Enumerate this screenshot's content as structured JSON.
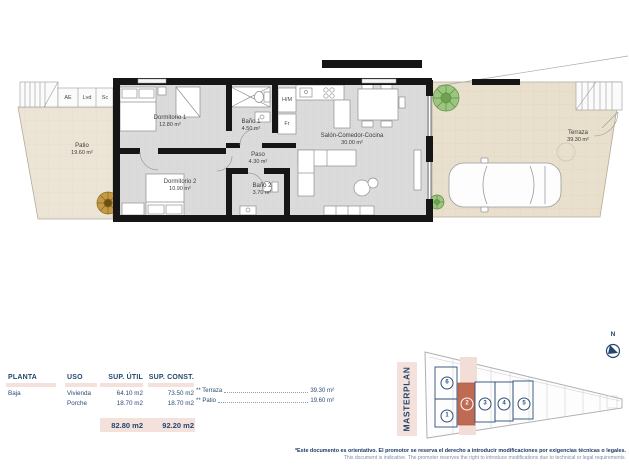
{
  "plan": {
    "rooms": [
      {
        "id": "patio",
        "name": "Patio",
        "area": "19.60 m²"
      },
      {
        "id": "dormitorio-1",
        "name": "Dormitorio 1",
        "area": "12.80 m²"
      },
      {
        "id": "bano-1",
        "name": "Baño 1",
        "area": "4.50 m²"
      },
      {
        "id": "paso",
        "name": "Paso",
        "area": "4.30 m²"
      },
      {
        "id": "dormitorio-2",
        "name": "Dormitorio 2",
        "area": "10.90 m²"
      },
      {
        "id": "bano-2",
        "name": "Baño 2",
        "area": "3.70 m²"
      },
      {
        "id": "salon",
        "name": "Salón-Comedor-Cocina",
        "area": "30.00 m²"
      },
      {
        "id": "terraza",
        "name": "Terraza",
        "area": "39.30 m²"
      }
    ],
    "closets": {
      "ae": "AE",
      "lvd": "Lvd",
      "sc": "Sc",
      "hm": "H/M",
      "fr": "Fr"
    }
  },
  "table": {
    "headers": [
      "PLANTA",
      "USO",
      "SUP. ÚTIL",
      "SUP. CONST."
    ],
    "planta": "Baja",
    "rows": [
      {
        "uso": "Vivienda",
        "util": "64.10 m2",
        "const": "73.50 m2"
      },
      {
        "uso": "Porche",
        "util": "18.70 m2",
        "const": "18.70 m2"
      }
    ],
    "extras": [
      {
        "label": "** Terraza",
        "value": "39.30 m²"
      },
      {
        "label": "** Patio",
        "value": "19.60 m²"
      }
    ],
    "totals": {
      "util": "82.80 m2",
      "const": "92.20 m2"
    }
  },
  "masterplan": {
    "title": "MASTERPLAN",
    "north": "N",
    "units": [
      "6",
      "1",
      "2",
      "3",
      "4",
      "5"
    ],
    "highlighted_unit": "2"
  },
  "disclaimer": {
    "es": "*Este documento es orientativo. El promotor se reserva el derecho a introducir modificaciones por exigencias técnicas o legales.",
    "en": "This document is indicative. The promoter reserves the right to introduce modifications due to technical or legal requirements."
  },
  "colors": {
    "accent_navy": "#24466e",
    "highlight_pink": "#f4e1db",
    "unit_highlight": "#bf6a52"
  }
}
